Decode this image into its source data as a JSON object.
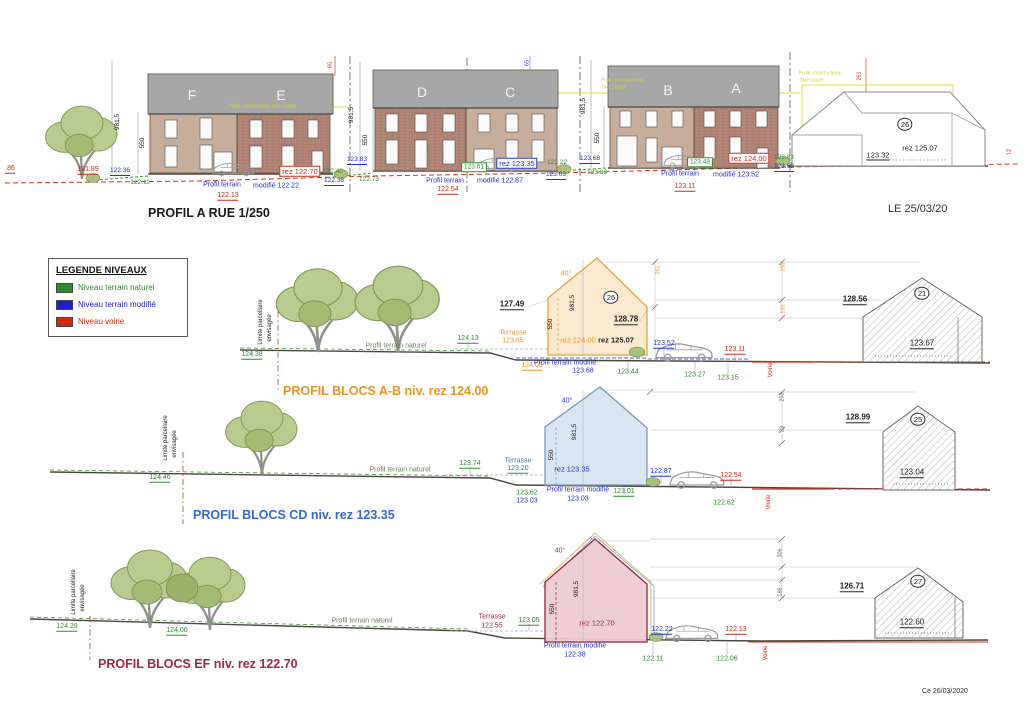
{
  "rue": {
    "title": "PROFIL A RUE 1/250",
    "blocks": [
      "F",
      "E",
      "D",
      "C",
      "B",
      "A"
    ]
  },
  "dates": {
    "top": "LE 25/03/20",
    "bottom": "Ce 26/03/2020"
  },
  "legend": {
    "title": "LEGENDE NIVEAUX",
    "items": [
      {
        "label": "Niveau terrain naturel",
        "color": "#2e8b2e"
      },
      {
        "label": "Niveau terrain modifié",
        "color": "#1f1fd4"
      },
      {
        "label": "Niveau voirie",
        "color": "#d42a10"
      }
    ]
  },
  "profiles": {
    "ab": {
      "title": "PROFIL BLOCS A-B niv. rez 124.00",
      "color": "#e8951f"
    },
    "cd": {
      "title": "PROFIL BLOCS CD niv. rez 123.35",
      "color": "#3568d4"
    },
    "ef": {
      "title": "PROFIL BLOCS EF niv. rez 122.70",
      "color": "#a12745"
    }
  },
  "colors": {
    "green": "#2e8b2e",
    "blue": "#2233cc",
    "red": "#cc2a1d",
    "orange": "#e8951f",
    "maroon": "#9c2744",
    "teal": "#3f7d99",
    "black": "#222222",
    "gray": "#666666",
    "olive": "#6f7d5e",
    "white": "#f5f5f5",
    "yellow": "#d9cf35"
  },
  "annotations": [
    {
      "t": ".86",
      "x": 10,
      "y": 169,
      "c": "red",
      "u": 1
    },
    {
      "t": "121.89",
      "x": 88,
      "y": 170,
      "c": "red",
      "u": 1
    },
    {
      "t": "981,5",
      "x": 118,
      "y": 122,
      "c": "black",
      "r": -90,
      "fs": 6.5
    },
    {
      "t": "550",
      "x": 143,
      "y": 143,
      "c": "black",
      "r": -90,
      "fs": 6.5
    },
    {
      "t": "F",
      "x": 192,
      "y": 95,
      "c": "white",
      "fs": 14
    },
    {
      "t": "E",
      "x": 281,
      "y": 95,
      "c": "white",
      "fs": 14
    },
    {
      "t": "Profil constructions face projet",
      "x": 262,
      "y": 107,
      "c": "yellow",
      "fs": 5
    },
    {
      "t": "65",
      "x": 331,
      "y": 65,
      "c": "red",
      "r": -90,
      "fs": 5.5
    },
    {
      "t": "122.36",
      "x": 120,
      "y": 172,
      "c": "blue",
      "u": 1,
      "fs": 6.5
    },
    {
      "t": "122.11",
      "x": 140,
      "y": 183,
      "c": "green",
      "fs": 6.5
    },
    {
      "t": "Profil terrain",
      "x": 222,
      "y": 185,
      "c": "blue",
      "fs": 7
    },
    {
      "t": "modifié 122.22",
      "x": 276,
      "y": 186,
      "c": "blue",
      "fs": 7
    },
    {
      "t": "122.13",
      "x": 228,
      "y": 196,
      "c": "red",
      "u": 1
    },
    {
      "t": "rez 122.70",
      "x": 300,
      "y": 171,
      "c": "red",
      "fs": 7.5,
      "bx": 1
    },
    {
      "t": "122.40",
      "x": 333,
      "y": 172,
      "c": "green",
      "fs": 6.5
    },
    {
      "t": "122.38",
      "x": 334,
      "y": 182,
      "c": "blue",
      "u": 1,
      "fs": 6.5
    },
    {
      "t": "122.73",
      "x": 369,
      "y": 180,
      "c": "green",
      "fs": 6.5
    },
    {
      "t": "123.83",
      "x": 357,
      "y": 161,
      "c": "blue",
      "u": 1,
      "fs": 6.5
    },
    {
      "t": "D",
      "x": 422,
      "y": 92,
      "c": "white",
      "fs": 14
    },
    {
      "t": "C",
      "x": 510,
      "y": 92,
      "c": "white",
      "fs": 14
    },
    {
      "t": "65",
      "x": 528,
      "y": 63,
      "c": "blue",
      "r": -90,
      "fs": 5.5
    },
    {
      "t": "981,5",
      "x": 352,
      "y": 115,
      "c": "black",
      "r": -90,
      "fs": 6.5
    },
    {
      "t": "550",
      "x": 366,
      "y": 140,
      "c": "black",
      "r": -90,
      "fs": 6.5
    },
    {
      "t": "123.01",
      "x": 474,
      "y": 167,
      "c": "green",
      "fs": 6.5,
      "bx": 1
    },
    {
      "t": "rez 123.35",
      "x": 517,
      "y": 163,
      "c": "blue",
      "fs": 7.5,
      "bx": 1
    },
    {
      "t": "123.22",
      "x": 557,
      "y": 163,
      "c": "green",
      "fs": 6.5
    },
    {
      "t": "123.68",
      "x": 590,
      "y": 160,
      "c": "blue",
      "u": 1,
      "fs": 6.5
    },
    {
      "t": "123.36",
      "x": 597,
      "y": 173,
      "c": "green",
      "fs": 6.5
    },
    {
      "t": "123.03",
      "x": 556,
      "y": 176,
      "c": "blue",
      "u": 1,
      "fs": 6.5
    },
    {
      "t": "Profil terrain",
      "x": 445,
      "y": 181,
      "c": "blue",
      "fs": 7
    },
    {
      "t": "modifié 122.87",
      "x": 500,
      "y": 181,
      "c": "blue",
      "fs": 7
    },
    {
      "t": "122.54",
      "x": 448,
      "y": 190,
      "c": "red",
      "u": 1
    },
    {
      "t": "981,5",
      "x": 584,
      "y": 106,
      "c": "black",
      "r": -90,
      "fs": 6.5
    },
    {
      "t": "550",
      "x": 598,
      "y": 138,
      "c": "black",
      "r": -90,
      "fs": 6.5
    },
    {
      "t": "Profil constructions",
      "x": 622,
      "y": 81,
      "c": "yellow",
      "fs": 5
    },
    {
      "t": "face projet",
      "x": 614,
      "y": 88,
      "c": "yellow",
      "fs": 5
    },
    {
      "t": "B",
      "x": 668,
      "y": 90,
      "c": "white",
      "fs": 14
    },
    {
      "t": "A",
      "x": 736,
      "y": 88,
      "c": "white",
      "fs": 14
    },
    {
      "t": "Profil terrain",
      "x": 680,
      "y": 174,
      "c": "blue",
      "fs": 7
    },
    {
      "t": "modifié 123.52",
      "x": 736,
      "y": 175,
      "c": "blue",
      "fs": 7
    },
    {
      "t": "123.11",
      "x": 685,
      "y": 187,
      "c": "red",
      "u": 1
    },
    {
      "t": "123.48",
      "x": 700,
      "y": 162,
      "c": "green",
      "fs": 6.5,
      "bx": 1
    },
    {
      "t": "rez 124.00",
      "x": 749,
      "y": 158,
      "c": "red",
      "fs": 7.5,
      "bx": 1
    },
    {
      "t": "123.83",
      "x": 784,
      "y": 158,
      "c": "green",
      "fs": 6.5
    },
    {
      "t": "123.68",
      "x": 784,
      "y": 168,
      "c": "blue",
      "u": 1,
      "fs": 6.5
    },
    {
      "t": "Profil constructions",
      "x": 820,
      "y": 74,
      "c": "yellow",
      "fs": 5
    },
    {
      "t": "face projet",
      "x": 812,
      "y": 81,
      "c": "yellow",
      "fs": 5
    },
    {
      "t": "261",
      "x": 860,
      "y": 76,
      "c": "red",
      "r": -90,
      "fs": 5.5
    },
    {
      "t": "26",
      "x": 905,
      "y": 124,
      "c": "black",
      "circ": 1,
      "fs": 7.5
    },
    {
      "t": "rez 125.07",
      "x": 920,
      "y": 148,
      "c": "black",
      "fs": 7.5
    },
    {
      "t": "123.32",
      "x": 878,
      "y": 156,
      "c": "black",
      "u": 1,
      "fs": 7.5
    },
    {
      "t": "12",
      "x": 1010,
      "y": 152,
      "c": "red",
      "r": -90,
      "fs": 5.5
    },
    {
      "t": "Limite parcellaire",
      "x": 261,
      "y": 322,
      "c": "black",
      "r": -90,
      "fs": 6
    },
    {
      "t": "envisagée",
      "x": 270,
      "y": 328,
      "c": "black",
      "r": -90,
      "fs": 6
    },
    {
      "t": "124.38",
      "x": 252,
      "y": 355,
      "c": "green",
      "u": 1
    },
    {
      "t": "Profil terrain naturel",
      "x": 396,
      "y": 346,
      "c": "olive",
      "fs": 7
    },
    {
      "t": "124.13",
      "x": 468,
      "y": 339,
      "c": "green",
      "u": 1
    },
    {
      "t": "Terrasse",
      "x": 513,
      "y": 333,
      "c": "orange",
      "fs": 7
    },
    {
      "t": "123.85",
      "x": 513,
      "y": 341,
      "c": "orange",
      "fs": 7
    },
    {
      "t": "40°",
      "x": 566,
      "y": 274,
      "c": "orange",
      "fs": 7
    },
    {
      "t": "550",
      "x": 551,
      "y": 324,
      "c": "black",
      "r": -90,
      "fs": 6.5
    },
    {
      "t": "981,5",
      "x": 573,
      "y": 303,
      "c": "black",
      "r": -90,
      "fs": 6.5
    },
    {
      "t": "26",
      "x": 611,
      "y": 297,
      "c": "black",
      "circ": 1,
      "fs": 7.5
    },
    {
      "t": "127.49",
      "x": 512,
      "y": 305,
      "c": "black",
      "u": 1,
      "fs": 8,
      "b": 1
    },
    {
      "t": "128.78",
      "x": 626,
      "y": 320,
      "c": "black",
      "u": 1,
      "fs": 8,
      "b": 1
    },
    {
      "t": "rez 124.00",
      "x": 578,
      "y": 340,
      "c": "orange",
      "fs": 7.5
    },
    {
      "t": "rez 125.07",
      "x": 616,
      "y": 340,
      "c": "black",
      "fs": 7.5,
      "b": 1
    },
    {
      "t": "123.52",
      "x": 664,
      "y": 344,
      "c": "blue",
      "u": 1
    },
    {
      "t": "123.11",
      "x": 735,
      "y": 350,
      "c": "red",
      "u": 1
    },
    {
      "t": "124.05",
      "x": 532,
      "y": 366,
      "c": "orange",
      "u": 1
    },
    {
      "t": "Profil terrain modifié",
      "x": 565,
      "y": 363,
      "c": "blue",
      "fs": 7
    },
    {
      "t": "123.68",
      "x": 583,
      "y": 371,
      "c": "blue",
      "fs": 7
    },
    {
      "t": "123.44",
      "x": 628,
      "y": 372,
      "c": "green"
    },
    {
      "t": "123.27",
      "x": 695,
      "y": 375,
      "c": "green"
    },
    {
      "t": "123.15",
      "x": 728,
      "y": 378,
      "c": "green"
    },
    {
      "t": "261",
      "x": 659,
      "y": 270,
      "c": "orange",
      "r": -90,
      "fs": 5.5
    },
    {
      "t": "205",
      "x": 784,
      "y": 267,
      "c": "orange",
      "r": -90,
      "fs": 5.5
    },
    {
      "t": "131",
      "x": 784,
      "y": 309,
      "c": "orange",
      "r": -90,
      "fs": 5.5
    },
    {
      "t": "128.56",
      "x": 855,
      "y": 300,
      "c": "black",
      "u": 1,
      "fs": 8,
      "b": 1
    },
    {
      "t": "21",
      "x": 922,
      "y": 293,
      "c": "black",
      "circ": 1,
      "fs": 7.5
    },
    {
      "t": "123.67",
      "x": 922,
      "y": 344,
      "c": "black",
      "u": 1,
      "fs": 8
    },
    {
      "t": "Voirie",
      "x": 771,
      "y": 370,
      "c": "red",
      "r": -90,
      "fs": 6
    },
    {
      "t": "Limite parcellaire",
      "x": 166,
      "y": 438,
      "c": "black",
      "r": -90,
      "fs": 6
    },
    {
      "t": "envisagée",
      "x": 175,
      "y": 444,
      "c": "black",
      "r": -90,
      "fs": 6
    },
    {
      "t": "124.46",
      "x": 160,
      "y": 478,
      "c": "green",
      "u": 1
    },
    {
      "t": "Profil terrain naturel",
      "x": 400,
      "y": 470,
      "c": "olive",
      "fs": 7
    },
    {
      "t": "123.74",
      "x": 470,
      "y": 464,
      "c": "green",
      "u": 1
    },
    {
      "t": "Terrasse",
      "x": 518,
      "y": 461,
      "c": "teal",
      "fs": 7
    },
    {
      "t": "123.20",
      "x": 518,
      "y": 469,
      "c": "teal",
      "u": 1,
      "fs": 7
    },
    {
      "t": "40°",
      "x": 567,
      "y": 401,
      "c": "blue",
      "fs": 7
    },
    {
      "t": "981,5",
      "x": 575,
      "y": 432,
      "c": "black",
      "r": -90,
      "fs": 6.5
    },
    {
      "t": "550",
      "x": 552,
      "y": 455,
      "c": "black",
      "r": -90,
      "fs": 6.5
    },
    {
      "t": "rez 123.35",
      "x": 572,
      "y": 469,
      "c": "blue",
      "fs": 7.5
    },
    {
      "t": "122.87",
      "x": 661,
      "y": 472,
      "c": "blue",
      "u": 1
    },
    {
      "t": "122.54",
      "x": 731,
      "y": 476,
      "c": "red",
      "u": 1
    },
    {
      "t": "123.62",
      "x": 527,
      "y": 493,
      "c": "green"
    },
    {
      "t": "123.03",
      "x": 527,
      "y": 501,
      "c": "blue"
    },
    {
      "t": "Profil terrain modifié",
      "x": 578,
      "y": 490,
      "c": "blue",
      "fs": 7
    },
    {
      "t": "123.03",
      "x": 578,
      "y": 499,
      "c": "blue",
      "fs": 7
    },
    {
      "t": "123.01",
      "x": 624,
      "y": 492,
      "c": "green",
      "u": 1
    },
    {
      "t": "122.62",
      "x": 724,
      "y": 503,
      "c": "green"
    },
    {
      "t": "203",
      "x": 783,
      "y": 397,
      "c": "gray",
      "r": -90,
      "fs": 5.5
    },
    {
      "t": "23",
      "x": 783,
      "y": 429,
      "c": "gray",
      "r": -90,
      "fs": 5.5
    },
    {
      "t": "128.99",
      "x": 858,
      "y": 418,
      "c": "black",
      "u": 1,
      "fs": 8,
      "b": 1
    },
    {
      "t": "25",
      "x": 918,
      "y": 419,
      "c": "black",
      "circ": 1,
      "fs": 7.5
    },
    {
      "t": "123.04",
      "x": 912,
      "y": 473,
      "c": "black",
      "u": 1,
      "fs": 8
    },
    {
      "t": "Voirie",
      "x": 769,
      "y": 502,
      "c": "red",
      "r": -90,
      "fs": 6
    },
    {
      "t": "Limite parcellaire",
      "x": 74,
      "y": 592,
      "c": "black",
      "r": -90,
      "fs": 6
    },
    {
      "t": "envisagée",
      "x": 83,
      "y": 598,
      "c": "black",
      "r": -90,
      "fs": 6
    },
    {
      "t": "124.29",
      "x": 67,
      "y": 627,
      "c": "green",
      "u": 1
    },
    {
      "t": "124.00",
      "x": 177,
      "y": 631,
      "c": "green",
      "u": 1
    },
    {
      "t": "Profil terrain naturel",
      "x": 362,
      "y": 621,
      "c": "olive",
      "fs": 7
    },
    {
      "t": "Terrasse",
      "x": 492,
      "y": 617,
      "c": "maroon",
      "fs": 7
    },
    {
      "t": "122.55",
      "x": 492,
      "y": 626,
      "c": "maroon",
      "fs": 7
    },
    {
      "t": "123.05",
      "x": 529,
      "y": 621,
      "c": "green",
      "u": 1
    },
    {
      "t": "40°",
      "x": 560,
      "y": 551,
      "c": "maroon",
      "fs": 7
    },
    {
      "t": "981,5",
      "x": 577,
      "y": 589,
      "c": "black",
      "r": -90,
      "fs": 6.5
    },
    {
      "t": "550",
      "x": 553,
      "y": 609,
      "c": "black",
      "r": -90,
      "fs": 6.5
    },
    {
      "t": "rez 122.70",
      "x": 597,
      "y": 623,
      "c": "maroon",
      "fs": 7.5
    },
    {
      "t": "122.22",
      "x": 662,
      "y": 630,
      "c": "blue",
      "u": 1
    },
    {
      "t": "122.13",
      "x": 736,
      "y": 630,
      "c": "red",
      "u": 1
    },
    {
      "t": "Profil terrain modifié",
      "x": 575,
      "y": 646,
      "c": "blue",
      "fs": 7
    },
    {
      "t": "122.38",
      "x": 575,
      "y": 655,
      "c": "blue",
      "fs": 7
    },
    {
      "t": "122.11",
      "x": 653,
      "y": 659,
      "c": "green"
    },
    {
      "t": "122.06",
      "x": 727,
      "y": 659,
      "c": "green"
    },
    {
      "t": "306",
      "x": 781,
      "y": 553,
      "c": "gray",
      "r": -90,
      "fs": 5.5
    },
    {
      "t": "186",
      "x": 781,
      "y": 592,
      "c": "gray",
      "r": -90,
      "fs": 5.5
    },
    {
      "t": "126.71",
      "x": 852,
      "y": 587,
      "c": "black",
      "u": 1,
      "fs": 8,
      "b": 1
    },
    {
      "t": "27",
      "x": 918,
      "y": 581,
      "c": "black",
      "circ": 1,
      "fs": 7.5
    },
    {
      "t": "122.60",
      "x": 912,
      "y": 623,
      "c": "black",
      "u": 1,
      "fs": 8
    },
    {
      "t": "Voirie",
      "x": 766,
      "y": 653,
      "c": "red",
      "r": -90,
      "fs": 6
    }
  ]
}
